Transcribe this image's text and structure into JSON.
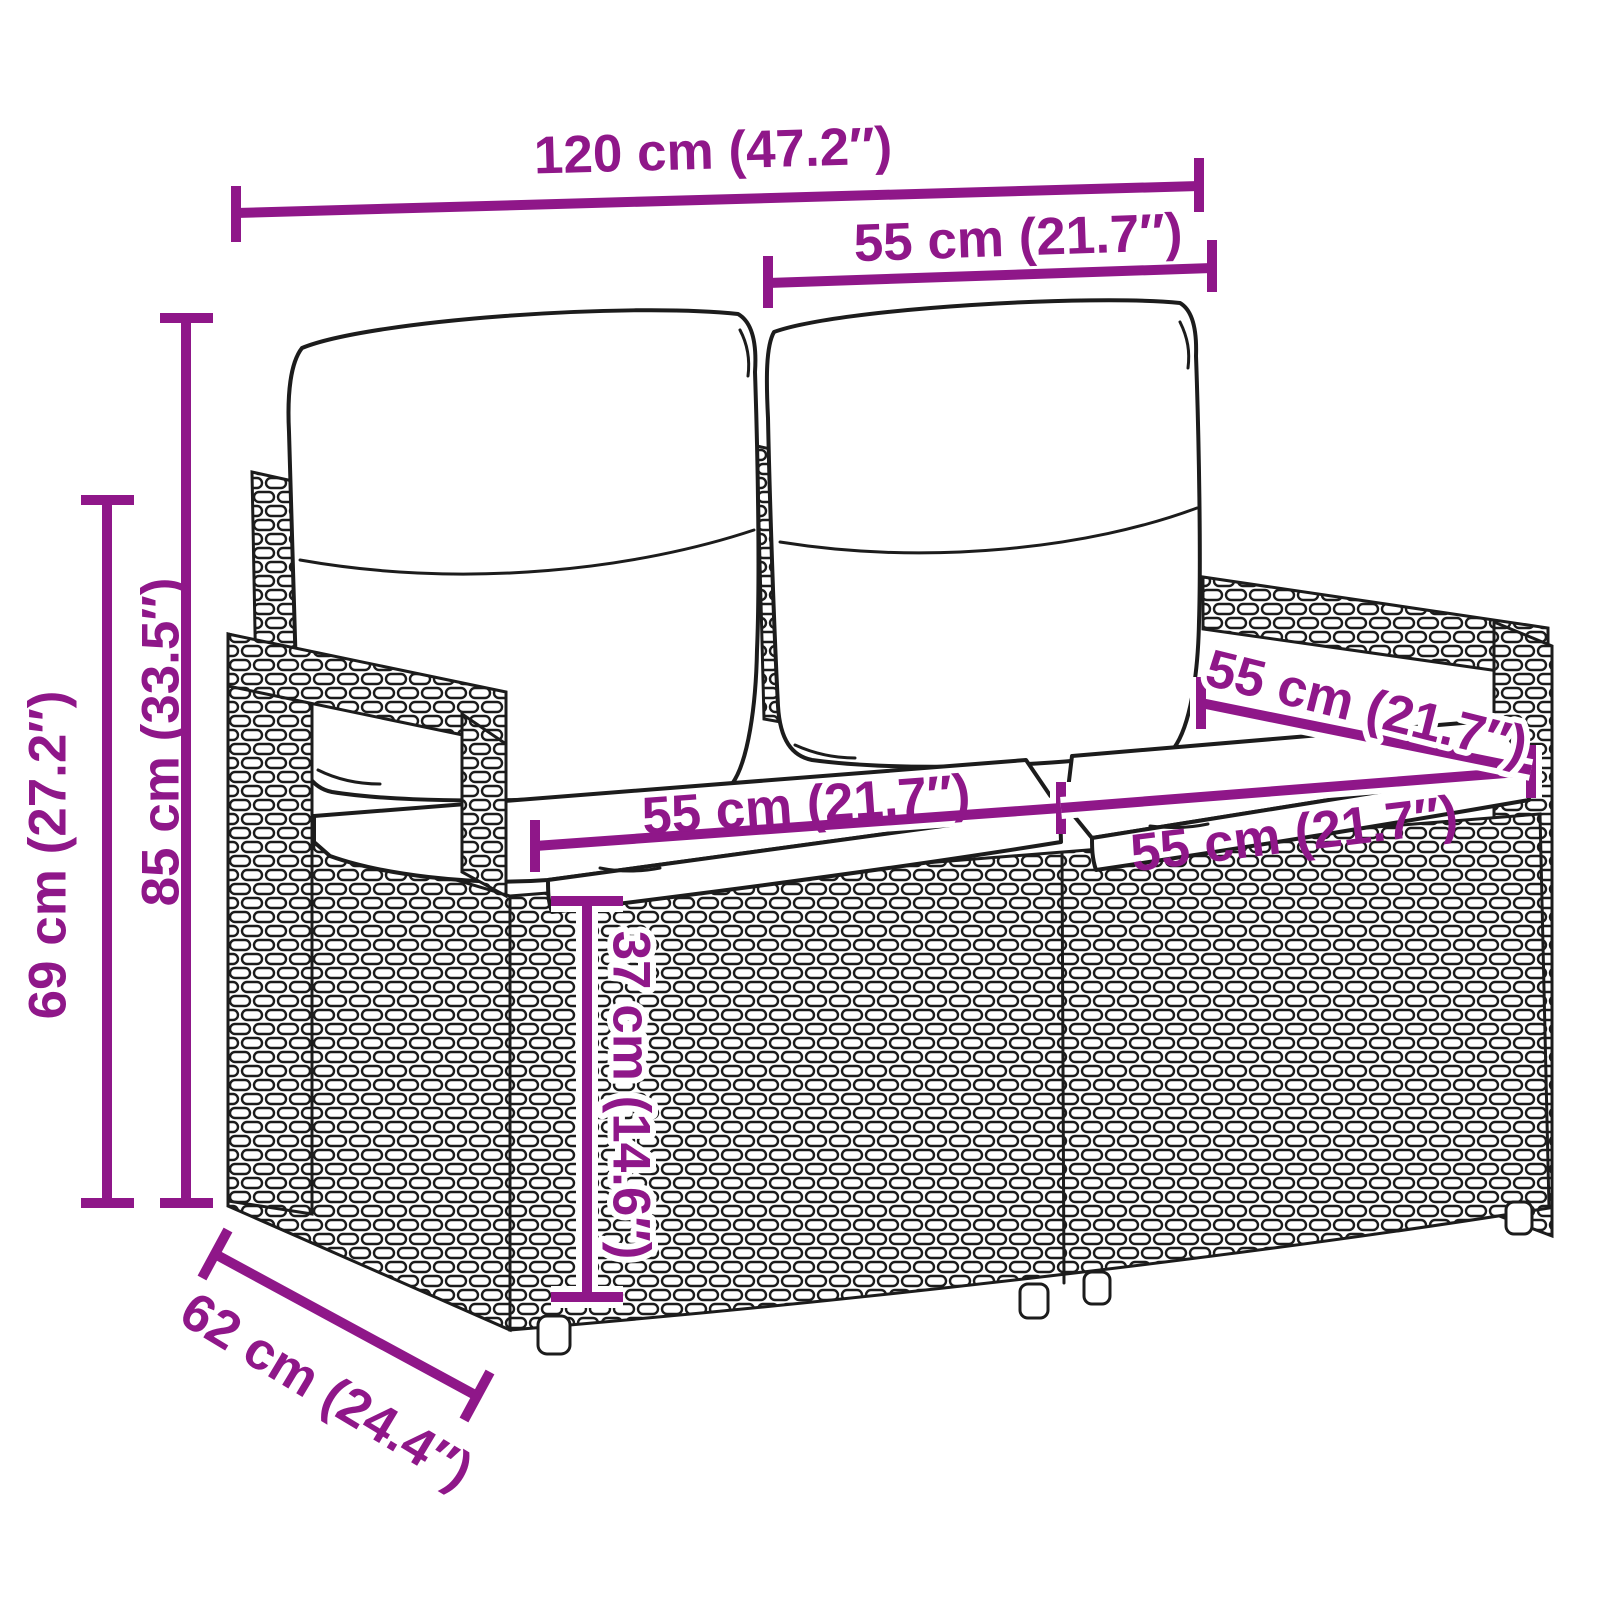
{
  "artwork": {
    "subject": "poly rattan two-seater garden bench with two back cushions and two seat cushions",
    "style": "black outline line drawing on white background"
  },
  "colors": {
    "dimension_annotation": "#8f1789",
    "line_art": "#1c1c1c",
    "background": "#ffffff"
  },
  "dims": {
    "total_width": {
      "label": "120 cm (47.2″)",
      "cm": 120,
      "inches": 47.2
    },
    "back_cushion_width": {
      "label": "55 cm (21.7″)",
      "cm": 55,
      "inches": 21.7
    },
    "total_height": {
      "label": "85 cm (33.5″)",
      "cm": 85,
      "inches": 33.5
    },
    "arm_height": {
      "label": "69 cm (27.2″)",
      "cm": 69,
      "inches": 27.2
    },
    "seat_width_left": {
      "label": "55 cm (21.7″)",
      "cm": 55,
      "inches": 21.7
    },
    "seat_width_right": {
      "label": "55 cm (21.7″)",
      "cm": 55,
      "inches": 21.7
    },
    "seat_depth": {
      "label": "55 cm (21.7″)",
      "cm": 55,
      "inches": 21.7
    },
    "seat_height": {
      "label": "37 cm (14.6″)",
      "cm": 37,
      "inches": 14.6
    },
    "total_depth": {
      "label": "62 cm (24.4″)",
      "cm": 62,
      "inches": 24.4
    }
  }
}
